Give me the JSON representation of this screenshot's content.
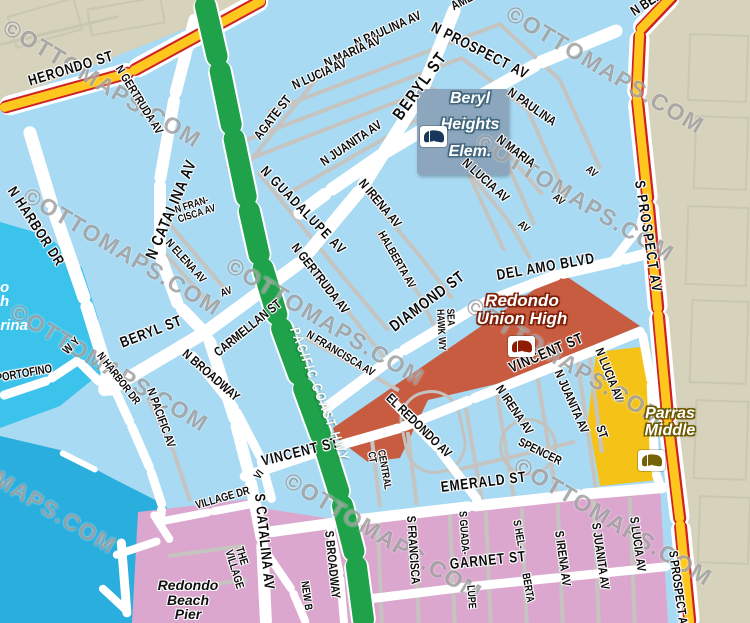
{
  "title": "Redondo Beach street map",
  "watermark": {
    "text": "©OTTOMAPS.COM",
    "rot": 31,
    "positions": [
      [
        5,
        12
      ],
      [
        508,
        -2
      ],
      [
        25,
        180
      ],
      [
        12,
        296
      ],
      [
        -80,
        418
      ],
      [
        228,
        250
      ],
      [
        286,
        465
      ],
      [
        516,
        450
      ],
      [
        478,
        126
      ],
      [
        468,
        290
      ]
    ]
  },
  "palette": {
    "land": "#A8DAF3",
    "tan": "#D6D2BC",
    "water": "#3CC3EC",
    "ocean": "#2AAEDE",
    "pink": "#DBA7CE",
    "red": "#C85C41",
    "syellow": "#F5C318",
    "green": "#1FA24A",
    "hyellow": "#FFC71E",
    "hred": "#CE2127",
    "gray_road": "#C6C4C0",
    "label": "#0C0C0C"
  },
  "labels": [
    {
      "t": "AMETHYST",
      "x": 452,
      "y": 10,
      "r": -28,
      "s": 13
    },
    {
      "t": "N PROSPECT AV",
      "x": 432,
      "y": 30,
      "r": 27,
      "s": 15,
      "ls": 1
    },
    {
      "t": "N PAULINA AV",
      "x": 355,
      "y": 47,
      "r": -24,
      "s": 13
    },
    {
      "t": "N MARIA AV",
      "x": 325,
      "y": 67,
      "r": -24,
      "s": 13
    },
    {
      "t": "N LUCIA AV",
      "x": 293,
      "y": 89,
      "r": -24,
      "s": 13
    },
    {
      "t": "AGATE ST",
      "x": 257,
      "y": 141,
      "r": -52,
      "s": 13
    },
    {
      "t": "N JUANITA AV",
      "x": 322,
      "y": 166,
      "r": -34,
      "s": 13
    },
    {
      "t": "BERYL ST",
      "x": 397,
      "y": 122,
      "r": -54,
      "s": 17,
      "ls": 2
    },
    {
      "t": "N GUADALUPE AV",
      "x": 263,
      "y": 172,
      "r": 46,
      "s": 14,
      "ls": 1.5
    },
    {
      "t": "N IRENA AV",
      "x": 361,
      "y": 184,
      "r": 50,
      "s": 13
    },
    {
      "t": "N LUCIA AV",
      "x": 464,
      "y": 164,
      "r": 42,
      "s": 13
    },
    {
      "t": "N MARIA",
      "x": 498,
      "y": 141,
      "r": 37,
      "s": 13
    },
    {
      "t": "N PAULINA",
      "x": 509,
      "y": 94,
      "r": 35,
      "s": 13
    },
    {
      "t": "AV",
      "x": 587,
      "y": 171,
      "r": 40,
      "s": 11
    },
    {
      "t": "AV",
      "x": 554,
      "y": 199,
      "r": 40,
      "s": 11
    },
    {
      "t": "AV",
      "x": 519,
      "y": 226,
      "r": 40,
      "s": 11
    },
    {
      "t": "N GERTRUDA AV",
      "x": 118,
      "y": 69,
      "r": 58,
      "s": 12
    },
    {
      "t": "N CATALINA AV",
      "x": 151,
      "y": 262,
      "r": -67,
      "s": 16,
      "ls": 1
    },
    {
      "lines": [
        "N FRAN-",
        "CISCA AV"
      ],
      "x": 177,
      "y": 213,
      "r": -18,
      "s": 10.5
    },
    {
      "t": "N ELENA AV",
      "x": 167,
      "y": 244,
      "r": 48,
      "s": 11.5
    },
    {
      "t": "AV",
      "x": 221,
      "y": 297,
      "r": -20,
      "s": 11
    },
    {
      "t": "HERONDO ST",
      "x": 29,
      "y": 85,
      "r": -17,
      "s": 15,
      "ls": 1
    },
    {
      "t": "N HARBOR DR",
      "x": 10,
      "y": 192,
      "r": 57,
      "s": 14.5,
      "ls": 1
    },
    {
      "t": "BERYL ST",
      "x": 121,
      "y": 347,
      "r": -21,
      "s": 15,
      "ls": 1
    },
    {
      "t": "N GERTRUDA AV",
      "x": 294,
      "y": 248,
      "r": 52,
      "s": 13
    },
    {
      "t": "CARMELLAN ST",
      "x": 216,
      "y": 357,
      "r": -39,
      "s": 13
    },
    {
      "t": "N FRANCISCA AV",
      "x": 307,
      "y": 337,
      "r": 31,
      "s": 11.5
    },
    {
      "t": "HALBERTA AV",
      "x": 380,
      "y": 235,
      "r": 60,
      "s": 11.5
    },
    {
      "t": "DIAMOND ST",
      "x": 392,
      "y": 332,
      "r": -37,
      "s": 16,
      "ls": 1
    },
    {
      "t": "DEL AMO BLVD",
      "x": 497,
      "y": 279,
      "r": -10,
      "s": 15,
      "ls": 1
    },
    {
      "t": "S PROSPECT AV",
      "x": 638,
      "y": 184,
      "r": 81,
      "s": 14.5,
      "ls": 2
    },
    {
      "lines": [
        "SEA",
        "HAWK WY"
      ],
      "x": 444,
      "y": 306,
      "r": 87,
      "s": 10.5
    },
    {
      "t": "VINCENT ST",
      "x": 510,
      "y": 372,
      "r": -23,
      "s": 15,
      "ls": 1
    },
    {
      "t": "VINCENT ST",
      "x": 262,
      "y": 465,
      "r": -14,
      "s": 15,
      "ls": 1
    },
    {
      "t": "N IRENA AV",
      "x": 498,
      "y": 390,
      "r": 56,
      "s": 12.5
    },
    {
      "t": "N JUANITA AV",
      "x": 557,
      "y": 374,
      "r": 66,
      "s": 12.5
    },
    {
      "t": "N LUCIA AV",
      "x": 598,
      "y": 352,
      "r": 68,
      "s": 12.5
    },
    {
      "t": "ST",
      "x": 599,
      "y": 429,
      "r": 72,
      "s": 12.5
    },
    {
      "t": "SPENCER",
      "x": 519,
      "y": 444,
      "r": 26,
      "s": 12
    },
    {
      "t": "EL REDONDO AV",
      "x": 388,
      "y": 399,
      "r": 44,
      "s": 13
    },
    {
      "lines": [
        "CENTRAL",
        "CT"
      ],
      "x": 375,
      "y": 448,
      "r": 80,
      "s": 10.5
    },
    {
      "t": "EMERALD ST",
      "x": 441,
      "y": 491,
      "r": -7,
      "s": 15,
      "ls": 1
    },
    {
      "t": "GARNET ST",
      "x": 450,
      "y": 568,
      "r": -6,
      "s": 15,
      "ls": 1
    },
    {
      "t": "S CATALINA AV",
      "x": 258,
      "y": 497,
      "r": 84,
      "s": 14.5,
      "ls": 1
    },
    {
      "t": "S BROADWAY",
      "x": 328,
      "y": 534,
      "r": 84,
      "s": 12.5
    },
    {
      "t": "NEW B",
      "x": 304,
      "y": 584,
      "r": 82,
      "s": 11
    },
    {
      "t": "S FRANCISCA",
      "x": 410,
      "y": 519,
      "r": 86,
      "s": 12.5
    },
    {
      "t": "S GUADA-",
      "x": 462,
      "y": 514,
      "r": 86,
      "s": 11
    },
    {
      "t": "LUPE",
      "x": 470,
      "y": 588,
      "r": 86,
      "s": 11
    },
    {
      "t": "S HEL-",
      "x": 516,
      "y": 523,
      "r": 80,
      "s": 11
    },
    {
      "t": "BERTA",
      "x": 525,
      "y": 576,
      "r": 80,
      "s": 11
    },
    {
      "t": "S IRENA AV",
      "x": 558,
      "y": 534,
      "r": 82,
      "s": 12.5
    },
    {
      "t": "S JUANITA AV",
      "x": 595,
      "y": 526,
      "r": 82,
      "s": 12.5
    },
    {
      "t": "S LUCIA AV",
      "x": 633,
      "y": 520,
      "r": 82,
      "s": 12.5
    },
    {
      "t": "S PROSPECT AV",
      "x": 672,
      "y": 554,
      "r": 82,
      "s": 12.5
    },
    {
      "t": "N BROADWAY",
      "x": 184,
      "y": 355,
      "r": 41,
      "s": 13
    },
    {
      "t": "N PACIFIC AV",
      "x": 150,
      "y": 391,
      "r": 70,
      "s": 12
    },
    {
      "t": "N HARBOR DR",
      "x": 99,
      "y": 357,
      "r": 52,
      "s": 11
    },
    {
      "t": "PORTOFINO",
      "x": -4,
      "y": 381,
      "r": -10,
      "s": 12
    },
    {
      "t": "WY",
      "x": 65,
      "y": 355,
      "r": -45,
      "s": 12,
      "ls": 4
    },
    {
      "t": "VILLAGE DR",
      "x": 196,
      "y": 509,
      "r": -16,
      "s": 11.5
    },
    {
      "lines": [
        "THE",
        "VILLAGE"
      ],
      "x": 233,
      "y": 546,
      "r": 73,
      "s": 11.5
    },
    {
      "t": "VI",
      "x": 257,
      "y": 481,
      "r": -55,
      "s": 11
    },
    {
      "t": "PACIFIC COAST HWY",
      "x": 294,
      "y": 331,
      "r": 69,
      "s": 14,
      "w": true,
      "ls": 2
    },
    {
      "t": "N BER",
      "x": 632,
      "y": 16,
      "r": -33,
      "s": 14
    }
  ],
  "schools": [
    {
      "id": "beryl-heights-elementary",
      "lines": [
        "Beryl",
        "Heights",
        "Elem."
      ],
      "cx": 470,
      "line_ys": [
        101,
        127,
        154
      ],
      "font": 16,
      "box": {
        "x": 417,
        "y": 89,
        "w": 92,
        "h": 86,
        "color": "#8BA6BD"
      },
      "icon": {
        "x": 420,
        "y": 126
      },
      "text_color": "#ffffff",
      "outline": "#44687f",
      "book": "#17375C"
    },
    {
      "id": "redondo-union-high",
      "lines": [
        "Redondo",
        "Union High"
      ],
      "cx": 522,
      "line_ys": [
        302,
        320
      ],
      "font": 17,
      "icon": {
        "x": 508,
        "y": 336
      },
      "text_color": "#ffffff",
      "outline": "#7E2008",
      "book": "#8E1C05"
    },
    {
      "id": "parras-middle",
      "lines": [
        "Parras",
        "Middle"
      ],
      "cx": 670,
      "line_ys": [
        416,
        433
      ],
      "font": 16,
      "icon": {
        "x": 638,
        "y": 450
      },
      "text_color": "#ffffff",
      "outline": "#6D5900",
      "book": "#756108"
    }
  ],
  "pier_label": {
    "lines": [
      "Redondo",
      "Beach",
      "Pier"
    ],
    "cx": 188,
    "line_ys": [
      585,
      600,
      614
    ],
    "font": 14
  },
  "marina_fragments": [
    {
      "t": "o",
      "x": 0,
      "y": 288,
      "s": 15
    },
    {
      "t": "h",
      "x": 0,
      "y": 302,
      "s": 15
    },
    {
      "t": "arina",
      "x": -8,
      "y": 326,
      "s": 15
    }
  ]
}
